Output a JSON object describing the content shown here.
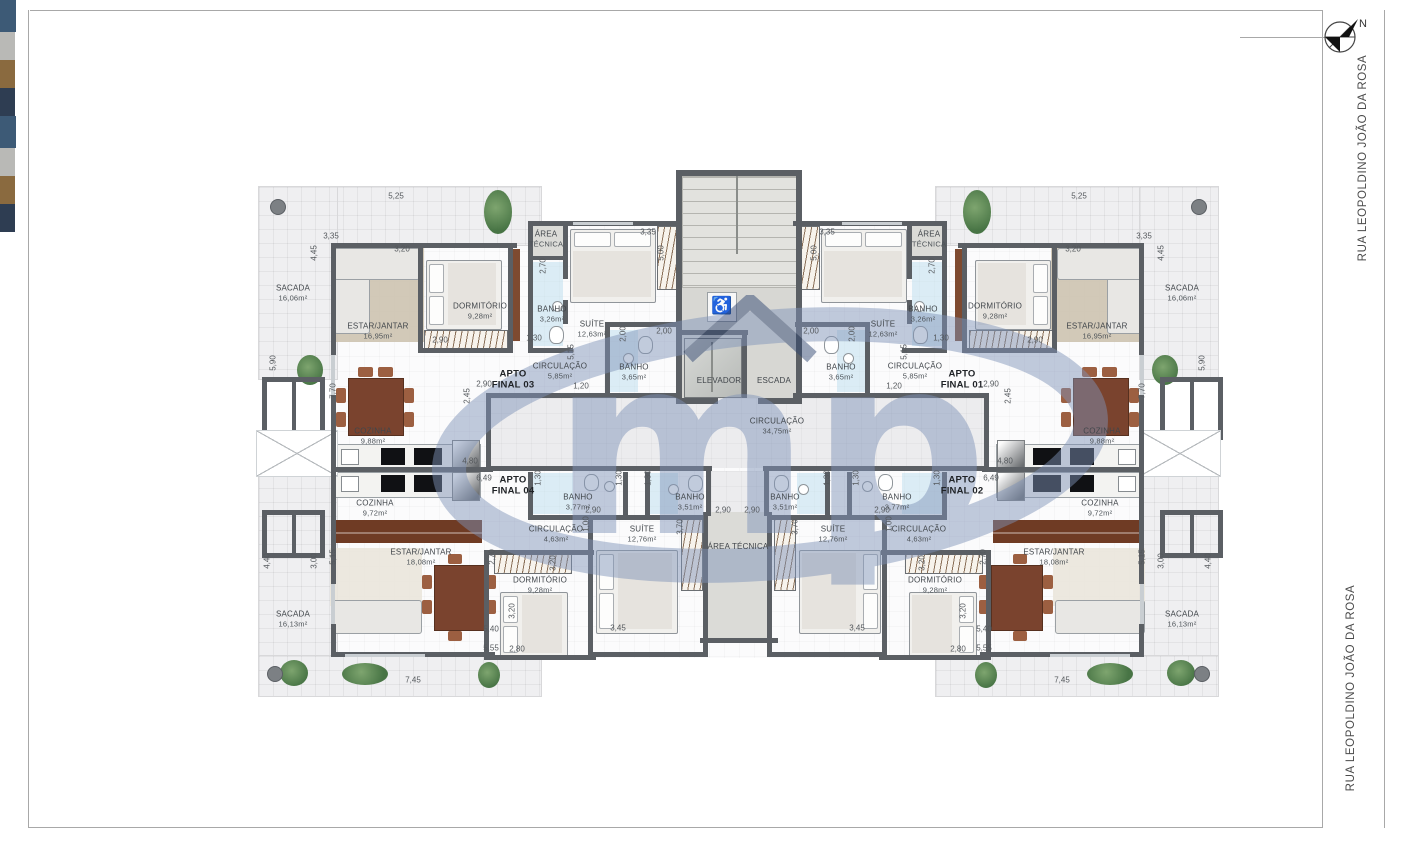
{
  "meta": {
    "north": "N",
    "street": "RUA LEOPOLDINO JOÃO DA ROSA",
    "watermark": "mp",
    "accent_blue": "#7f93b8",
    "wall_color": "#5b5f64"
  },
  "street_positions": [
    {
      "x": 1363,
      "y": 158
    },
    {
      "x": 1351,
      "y": 688
    }
  ],
  "apartments": [
    {
      "l1": "APTO",
      "l2": "FINAL 03",
      "x": 513,
      "y": 380
    },
    {
      "l1": "APTO",
      "l2": "FINAL 01",
      "x": 962,
      "y": 380
    },
    {
      "l1": "APTO",
      "l2": "FINAL 04",
      "x": 513,
      "y": 486
    },
    {
      "l1": "APTO",
      "l2": "FINAL 02",
      "x": 962,
      "y": 486
    }
  ],
  "core_labels": [
    {
      "l1": "ELEVADOR",
      "l2": "",
      "x": 719,
      "y": 381,
      "bold": 0
    },
    {
      "l1": "ESCADA",
      "l2": "",
      "x": 774,
      "y": 381,
      "bold": 0
    },
    {
      "l1": "CIRCULAÇÃO",
      "l2": "34,75m²",
      "x": 777,
      "y": 426,
      "bold": 0
    },
    {
      "l1": "ÁREA TÉCNICA",
      "l2": "",
      "x": 738,
      "y": 547,
      "bold": 0
    }
  ],
  "rooms_mirrored": [
    [
      "SACADA",
      "16,06m²",
      293,
      293
    ],
    [
      "ESTAR/JANTAR",
      "16,95m²",
      378,
      331
    ],
    [
      "DORMITÓRIO",
      "9,28m²",
      480,
      311
    ],
    [
      "ÁREA",
      "TÉCNICA",
      546,
      239
    ],
    [
      "BANHO",
      "3,26m²",
      552,
      314
    ],
    [
      "SUÍTE",
      "12,63m²",
      592,
      329
    ],
    [
      "CIRCULAÇÃO",
      "5,85m²",
      560,
      371
    ],
    [
      "BANHO",
      "3,65m²",
      634,
      372
    ],
    [
      "COZINHA",
      "9,88m²",
      373,
      436
    ],
    [
      "COZINHA",
      "9,72m²",
      375,
      508
    ],
    [
      "BANHO",
      "3,77m²",
      578,
      502
    ],
    [
      "BANHO",
      "3,51m²",
      690,
      502
    ],
    [
      "CIRCULAÇÃO",
      "4,63m²",
      556,
      534
    ],
    [
      "SUÍTE",
      "12,76m²",
      642,
      534
    ],
    [
      "DORMITÓRIO",
      "9,28m²",
      540,
      585
    ],
    [
      "ESTAR/JANTAR",
      "18,08m²",
      421,
      557
    ],
    [
      "SACADA",
      "16,13m²",
      293,
      619
    ]
  ],
  "dims_mirrored": [
    [
      "5,25",
      396,
      196,
      0
    ],
    [
      "3,35",
      331,
      236,
      0
    ],
    [
      "4,45",
      314,
      253,
      1
    ],
    [
      "3,20",
      402,
      249,
      0
    ],
    [
      "3,35",
      648,
      232,
      0
    ],
    [
      "5,00",
      661,
      253,
      1
    ],
    [
      "2,70",
      543,
      266,
      1
    ],
    [
      "2,00",
      664,
      331,
      0
    ],
    [
      "2,00",
      623,
      334,
      1
    ],
    [
      "1,30",
      534,
      338,
      0
    ],
    [
      "5,15",
      571,
      352,
      1
    ],
    [
      "2,90",
      440,
      340,
      0
    ],
    [
      "2,90",
      484,
      384,
      0
    ],
    [
      "2,45",
      467,
      396,
      1
    ],
    [
      "1,20",
      581,
      386,
      0
    ],
    [
      "7,70",
      333,
      391,
      1
    ],
    [
      "5,90",
      273,
      363,
      1
    ],
    [
      "4,80",
      470,
      461,
      0
    ],
    [
      "6,49",
      484,
      478,
      0
    ],
    [
      "1,30",
      538,
      478,
      1
    ],
    [
      "1,30",
      619,
      478,
      1
    ],
    [
      "1,30",
      648,
      478,
      1
    ],
    [
      "2,90",
      593,
      510,
      0
    ],
    [
      "2,90",
      723,
      510,
      0
    ],
    [
      "1,00",
      586,
      524,
      1
    ],
    [
      "3,20",
      553,
      563,
      1
    ],
    [
      "3,70",
      680,
      527,
      1
    ],
    [
      "2,70",
      492,
      557,
      1
    ],
    [
      "3,20",
      512,
      611,
      1
    ],
    [
      "3,45",
      618,
      628,
      0
    ],
    [
      "5,40",
      491,
      629,
      0
    ],
    [
      "5,55",
      491,
      648,
      0
    ],
    [
      "2,80",
      517,
      649,
      0
    ],
    [
      "7,45",
      413,
      680,
      0
    ],
    [
      "4,40",
      267,
      561,
      1
    ],
    [
      "3,00",
      314,
      561,
      1
    ],
    [
      "5,15",
      333,
      557,
      1
    ]
  ],
  "geometry": {
    "plates": [
      [
        334,
        221,
        807,
        437,
        "int",
        0
      ],
      [
        258,
        186,
        282,
        58,
        "sac",
        1
      ],
      [
        258,
        186,
        78,
        192,
        "sac",
        1
      ],
      [
        258,
        473,
        78,
        222,
        "sac",
        1
      ],
      [
        258,
        655,
        282,
        40,
        "sac",
        1
      ],
      [
        528,
        226,
        35,
        30,
        "at",
        1
      ],
      [
        486,
        398,
        503,
        70,
        "cor",
        0
      ],
      [
        678,
        176,
        118,
        222,
        "core",
        0
      ],
      [
        711,
        471,
        53,
        45,
        "cor",
        0
      ],
      [
        708,
        512,
        59,
        128,
        "at",
        0
      ]
    ],
    "walls": [
      [
        331,
        243,
        186,
        5,
        1
      ],
      [
        418,
        243,
        5,
        110,
        1
      ],
      [
        508,
        243,
        5,
        110,
        1
      ],
      [
        418,
        348,
        95,
        5,
        1
      ],
      [
        528,
        221,
        40,
        5,
        1
      ],
      [
        528,
        221,
        5,
        132,
        1
      ],
      [
        528,
        256,
        38,
        4,
        1
      ],
      [
        528,
        348,
        45,
        5,
        1
      ],
      [
        563,
        221,
        119,
        5,
        1
      ],
      [
        563,
        221,
        5,
        58,
        1
      ],
      [
        563,
        300,
        5,
        24,
        1
      ],
      [
        605,
        322,
        75,
        5,
        1
      ],
      [
        605,
        327,
        5,
        70,
        1
      ],
      [
        486,
        393,
        196,
        5,
        1
      ],
      [
        486,
        393,
        5,
        78,
        1
      ],
      [
        486,
        466,
        226,
        5,
        1
      ],
      [
        706,
        466,
        5,
        50,
        1
      ],
      [
        331,
        243,
        5,
        112,
        1
      ],
      [
        331,
        395,
        5,
        74,
        1
      ],
      [
        331,
        467,
        162,
        5,
        1
      ],
      [
        331,
        472,
        5,
        112,
        1
      ],
      [
        331,
        624,
        5,
        33,
        1
      ],
      [
        331,
        652,
        164,
        5,
        1
      ],
      [
        528,
        472,
        5,
        48,
        1
      ],
      [
        528,
        515,
        100,
        5,
        1
      ],
      [
        623,
        472,
        5,
        48,
        1
      ],
      [
        645,
        472,
        5,
        48,
        1
      ],
      [
        623,
        515,
        85,
        5,
        1
      ],
      [
        484,
        550,
        110,
        5,
        1
      ],
      [
        484,
        550,
        5,
        110,
        1
      ],
      [
        484,
        655,
        112,
        5,
        1
      ],
      [
        588,
        515,
        5,
        142,
        1
      ],
      [
        703,
        512,
        5,
        145,
        1
      ],
      [
        588,
        652,
        120,
        5,
        1
      ],
      [
        676,
        170,
        126,
        6,
        0
      ],
      [
        676,
        170,
        6,
        234,
        0
      ],
      [
        796,
        170,
        6,
        234,
        0
      ],
      [
        676,
        398,
        42,
        6,
        0
      ],
      [
        758,
        398,
        44,
        6,
        0
      ],
      [
        676,
        330,
        72,
        5,
        0
      ],
      [
        742,
        330,
        5,
        68,
        0
      ],
      [
        700,
        638,
        78,
        5,
        0
      ]
    ],
    "windows": [
      [
        331,
        355,
        4,
        40,
        1
      ],
      [
        331,
        584,
        4,
        40,
        1
      ],
      [
        345,
        654,
        80,
        3,
        1
      ],
      [
        573,
        222,
        60,
        3,
        1
      ]
    ],
    "furniture": [
      [
        "rug",
        336,
        246,
        88,
        96,
        1,
        "#cdc3b0"
      ],
      [
        "sofa",
        334,
        248,
        34,
        84,
        1
      ],
      [
        "sofa",
        334,
        248,
        84,
        30,
        1
      ],
      [
        "tbl",
        348,
        378,
        54,
        56,
        1
      ],
      [
        "chr",
        336,
        388,
        10,
        15,
        1
      ],
      [
        "chr",
        336,
        412,
        10,
        15,
        1
      ],
      [
        "chr",
        404,
        388,
        10,
        15,
        1
      ],
      [
        "chr",
        404,
        412,
        10,
        15,
        1
      ],
      [
        "chr",
        358,
        367,
        15,
        10,
        1
      ],
      [
        "chr",
        378,
        367,
        15,
        10,
        1
      ],
      [
        "bed",
        426,
        260,
        74,
        68,
        1,
        "l"
      ],
      [
        "hat",
        424,
        330,
        82,
        20,
        1
      ],
      [
        "box",
        486,
        332,
        16,
        16,
        1,
        "bl"
      ],
      [
        "pnl",
        511,
        249,
        9,
        92,
        1
      ],
      [
        "bed",
        570,
        229,
        84,
        72,
        1,
        "t"
      ],
      [
        "hat",
        657,
        226,
        20,
        62,
        1
      ],
      [
        "box",
        659,
        291,
        15,
        14,
        1,
        "g"
      ],
      [
        "box",
        659,
        307,
        15,
        14,
        1,
        "br"
      ],
      [
        "box",
        659,
        323,
        15,
        14,
        1,
        "dk"
      ],
      [
        "tint",
        533,
        262,
        30,
        84,
        1
      ],
      [
        "wc",
        549,
        326,
        13,
        16,
        1
      ],
      [
        "snk",
        552,
        301,
        9,
        9,
        1
      ],
      [
        "tint",
        610,
        330,
        28,
        62,
        1
      ],
      [
        "wc",
        638,
        336,
        13,
        16,
        1
      ],
      [
        "snk",
        623,
        353,
        9,
        9,
        1
      ],
      [
        "cnt",
        333,
        444,
        146,
        24,
        1
      ],
      [
        "ksk",
        341,
        449,
        16,
        14,
        1
      ],
      [
        "stv",
        381,
        448,
        24,
        17,
        1
      ],
      [
        "stv",
        414,
        448,
        28,
        17,
        1
      ],
      [
        "frg",
        452,
        440,
        26,
        29,
        1
      ],
      [
        "cnt",
        333,
        472,
        146,
        24,
        1
      ],
      [
        "ksk",
        341,
        476,
        16,
        14,
        1
      ],
      [
        "stv",
        381,
        475,
        24,
        17,
        1
      ],
      [
        "stv",
        414,
        475,
        28,
        17,
        1
      ],
      [
        "frg",
        452,
        472,
        26,
        27,
        1
      ],
      [
        "buf",
        332,
        520,
        150,
        23,
        1
      ],
      [
        "rug",
        330,
        548,
        92,
        58,
        1,
        "#eae6dc"
      ],
      [
        "sofa",
        332,
        600,
        88,
        32,
        1
      ],
      [
        "tbl",
        434,
        565,
        50,
        64,
        1
      ],
      [
        "chr",
        422,
        575,
        10,
        14,
        1
      ],
      [
        "chr",
        422,
        600,
        10,
        14,
        1
      ],
      [
        "chr",
        486,
        575,
        10,
        14,
        1
      ],
      [
        "chr",
        486,
        600,
        10,
        14,
        1
      ],
      [
        "chr",
        448,
        554,
        14,
        10,
        1
      ],
      [
        "chr",
        448,
        631,
        14,
        10,
        1
      ],
      [
        "bed",
        500,
        592,
        66,
        64,
        1,
        "l"
      ],
      [
        "hat",
        494,
        552,
        76,
        20,
        1
      ],
      [
        "box",
        548,
        554,
        16,
        16,
        1,
        "bl"
      ],
      [
        "bed",
        596,
        550,
        80,
        82,
        1,
        "l"
      ],
      [
        "hat",
        681,
        515,
        20,
        74,
        1
      ],
      [
        "box",
        683,
        595,
        15,
        14,
        1,
        "g"
      ],
      [
        "box",
        683,
        611,
        15,
        14,
        1,
        "br"
      ],
      [
        "box",
        683,
        627,
        15,
        14,
        1,
        "dk"
      ],
      [
        "tint",
        531,
        473,
        42,
        41,
        1
      ],
      [
        "wc",
        584,
        474,
        13,
        15,
        1
      ],
      [
        "snk",
        604,
        481,
        9,
        9,
        1
      ],
      [
        "tint",
        650,
        473,
        28,
        41,
        1
      ],
      [
        "wc",
        688,
        475,
        13,
        15,
        1
      ],
      [
        "snk",
        668,
        484,
        9,
        9,
        1
      ],
      [
        "plt",
        484,
        190,
        28,
        44,
        1
      ],
      [
        "plt",
        297,
        355,
        26,
        30,
        1
      ],
      [
        "plt",
        280,
        660,
        28,
        26,
        1
      ],
      [
        "plt",
        342,
        663,
        46,
        22,
        1
      ],
      [
        "plt",
        478,
        662,
        22,
        26,
        1
      ],
      [
        "col",
        270,
        199,
        14,
        14,
        1
      ],
      [
        "col",
        267,
        666,
        14,
        14,
        1
      ],
      [
        "wbx",
        262,
        377,
        53,
        53,
        1
      ],
      [
        "wbx",
        262,
        510,
        53,
        38,
        1
      ],
      [
        "xsh",
        256,
        430,
        80,
        45,
        1
      ],
      [
        "stairs",
        682,
        176,
        114,
        110,
        0
      ],
      [
        "ln",
        736,
        176,
        2,
        78,
        0
      ],
      [
        "elev",
        684,
        338,
        56,
        58,
        0
      ],
      [
        "ln",
        711,
        342,
        2,
        50,
        0
      ],
      [
        "whb",
        707,
        292,
        28,
        28,
        0
      ]
    ],
    "boundary": [
      [
        30,
        10,
        1292,
        1
      ],
      [
        28,
        10,
        1,
        818
      ],
      [
        28,
        827,
        1294,
        1
      ],
      [
        1322,
        10,
        1,
        818
      ],
      [
        1384,
        10,
        1,
        818
      ]
    ],
    "north_line": [
      1240,
      37,
      92,
      1
    ]
  }
}
